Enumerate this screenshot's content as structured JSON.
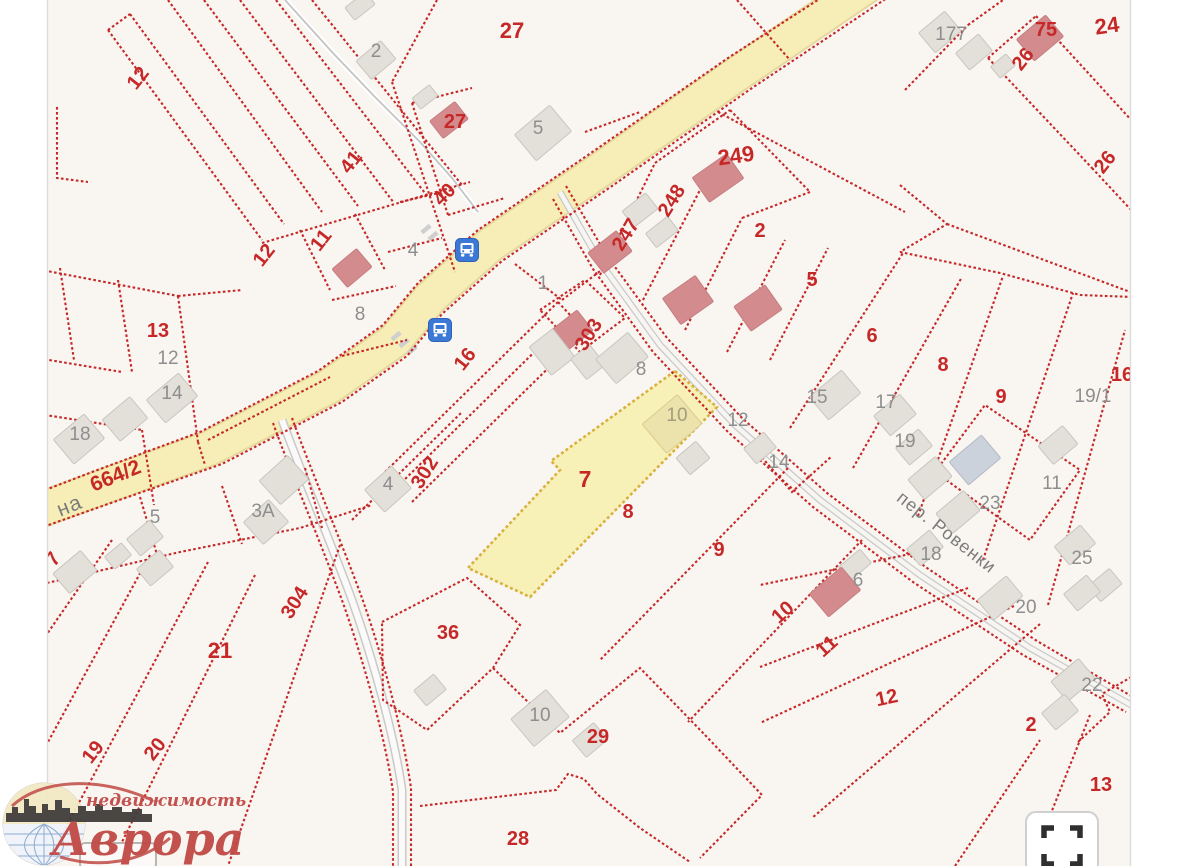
{
  "map": {
    "selected_parcel": "7",
    "labels": [
      {
        "t": "12",
        "x": 143,
        "y": 82,
        "r": -52,
        "c": "red"
      },
      {
        "t": "41",
        "x": 356,
        "y": 166,
        "r": -52,
        "c": "red"
      },
      {
        "t": "11",
        "x": 326,
        "y": 244,
        "r": -52,
        "c": "red"
      },
      {
        "t": "12",
        "x": 269,
        "y": 259,
        "r": -52,
        "c": "red"
      },
      {
        "t": "27",
        "x": 512,
        "y": 38,
        "s": 22,
        "c": "red"
      },
      {
        "t": "27",
        "x": 455,
        "y": 128,
        "c": "red"
      },
      {
        "t": "40",
        "x": 449,
        "y": 199,
        "r": -45,
        "c": "red"
      },
      {
        "t": "249",
        "x": 737,
        "y": 163,
        "r": -8,
        "s": 22,
        "c": "red"
      },
      {
        "t": "248",
        "x": 677,
        "y": 204,
        "r": -58,
        "c": "red"
      },
      {
        "t": "247",
        "x": 631,
        "y": 238,
        "r": -58,
        "c": "red"
      },
      {
        "t": "2",
        "x": 760,
        "y": 237,
        "c": "red"
      },
      {
        "t": "5",
        "x": 812,
        "y": 286,
        "c": "red"
      },
      {
        "t": "6",
        "x": 872,
        "y": 342,
        "c": "red"
      },
      {
        "t": "8",
        "x": 943,
        "y": 371,
        "c": "red"
      },
      {
        "t": "9",
        "x": 1001,
        "y": 403,
        "c": "red"
      },
      {
        "t": "24",
        "x": 1108,
        "y": 33,
        "r": -8,
        "s": 22,
        "c": "red"
      },
      {
        "t": "75",
        "x": 1046,
        "y": 36,
        "c": "red"
      },
      {
        "t": "26",
        "x": 1028,
        "y": 63,
        "r": -52,
        "c": "red"
      },
      {
        "t": "26",
        "x": 1110,
        "y": 166,
        "r": -52,
        "c": "red"
      },
      {
        "t": "13",
        "x": 158,
        "y": 337,
        "c": "red"
      },
      {
        "t": "664/2",
        "x": 118,
        "y": 482,
        "r": -22,
        "s": 21,
        "c": "red"
      },
      {
        "t": "303",
        "x": 594,
        "y": 338,
        "r": -58,
        "c": "red"
      },
      {
        "t": "16",
        "x": 470,
        "y": 363,
        "r": -52,
        "c": "red"
      },
      {
        "t": "302",
        "x": 430,
        "y": 476,
        "r": -58,
        "c": "red"
      },
      {
        "t": "7",
        "x": 585,
        "y": 487,
        "s": 23,
        "c": "red"
      },
      {
        "t": "8",
        "x": 628,
        "y": 518,
        "c": "red"
      },
      {
        "t": "9",
        "x": 719,
        "y": 556,
        "c": "red"
      },
      {
        "t": "7",
        "x": 58,
        "y": 563,
        "r": -52,
        "c": "red"
      },
      {
        "t": "304",
        "x": 300,
        "y": 606,
        "r": -58,
        "c": "red"
      },
      {
        "t": "21",
        "x": 220,
        "y": 658,
        "s": 22,
        "c": "red"
      },
      {
        "t": "19",
        "x": 98,
        "y": 756,
        "r": -52,
        "c": "red"
      },
      {
        "t": "20",
        "x": 160,
        "y": 753,
        "r": -52,
        "c": "red"
      },
      {
        "t": "36",
        "x": 448,
        "y": 639,
        "c": "red"
      },
      {
        "t": "29",
        "x": 598,
        "y": 743,
        "c": "red"
      },
      {
        "t": "28",
        "x": 518,
        "y": 845,
        "c": "red"
      },
      {
        "t": "10",
        "x": 787,
        "y": 617,
        "r": -42,
        "c": "red"
      },
      {
        "t": "11",
        "x": 831,
        "y": 651,
        "r": -42,
        "c": "red"
      },
      {
        "t": "12",
        "x": 888,
        "y": 704,
        "r": -12,
        "c": "red"
      },
      {
        "t": "2",
        "x": 1031,
        "y": 731,
        "c": "red"
      },
      {
        "t": "13",
        "x": 1101,
        "y": 791,
        "c": "red"
      },
      {
        "t": "16",
        "x": 1122,
        "y": 381,
        "c": "red"
      },
      {
        "t": "2",
        "x": 376,
        "y": 57,
        "c": "gray"
      },
      {
        "t": "5",
        "x": 538,
        "y": 134,
        "c": "gray"
      },
      {
        "t": "4",
        "x": 413,
        "y": 256,
        "c": "gray"
      },
      {
        "t": "1",
        "x": 543,
        "y": 289,
        "c": "gray"
      },
      {
        "t": "177",
        "x": 951,
        "y": 40,
        "c": "gray"
      },
      {
        "t": "12",
        "x": 168,
        "y": 364,
        "c": "gray"
      },
      {
        "t": "14",
        "x": 172,
        "y": 399,
        "c": "gray"
      },
      {
        "t": "18",
        "x": 80,
        "y": 440,
        "c": "gray"
      },
      {
        "t": "5",
        "x": 155,
        "y": 523,
        "c": "gray"
      },
      {
        "t": "3А",
        "x": 263,
        "y": 517,
        "c": "gray"
      },
      {
        "t": "8",
        "x": 360,
        "y": 320,
        "c": "gray"
      },
      {
        "t": "4",
        "x": 388,
        "y": 490,
        "c": "gray"
      },
      {
        "t": "8",
        "x": 641,
        "y": 375,
        "c": "gray"
      },
      {
        "t": "10",
        "x": 677,
        "y": 421,
        "c": "khaki"
      },
      {
        "t": "12",
        "x": 738,
        "y": 426,
        "c": "gray"
      },
      {
        "t": "14",
        "x": 779,
        "y": 468,
        "c": "gray"
      },
      {
        "t": "15",
        "x": 817,
        "y": 403,
        "c": "gray"
      },
      {
        "t": "17",
        "x": 886,
        "y": 408,
        "c": "gray"
      },
      {
        "t": "19",
        "x": 905,
        "y": 447,
        "c": "gray"
      },
      {
        "t": "19/1",
        "x": 1093,
        "y": 402,
        "c": "gray"
      },
      {
        "t": "23",
        "x": 990,
        "y": 509,
        "c": "gray"
      },
      {
        "t": "11",
        "x": 1052,
        "y": 489,
        "c": "gray"
      },
      {
        "t": "18",
        "x": 931,
        "y": 560,
        "c": "gray"
      },
      {
        "t": "25",
        "x": 1082,
        "y": 564,
        "c": "gray"
      },
      {
        "t": "6",
        "x": 858,
        "y": 586,
        "c": "gray"
      },
      {
        "t": "20",
        "x": 1026,
        "y": 613,
        "c": "gray"
      },
      {
        "t": "22",
        "x": 1092,
        "y": 691,
        "c": "gray"
      },
      {
        "t": "10",
        "x": 540,
        "y": 721,
        "c": "gray"
      }
    ],
    "street_labels": [
      {
        "t": "на",
        "x": 72,
        "y": 512,
        "r": -22,
        "s": 21
      },
      {
        "t": "пер. Ровенки",
        "x": 943,
        "y": 537,
        "r": 38,
        "s": 18
      }
    ],
    "buildings": [
      {
        "x": 360,
        "y": 6,
        "w": 26,
        "h": 16,
        "r": -38,
        "c": "gray"
      },
      {
        "x": 376,
        "y": 60,
        "w": 32,
        "h": 24,
        "r": -40,
        "c": "gray"
      },
      {
        "x": 425,
        "y": 97,
        "w": 22,
        "h": 14,
        "r": -38,
        "c": "gray"
      },
      {
        "x": 449,
        "y": 120,
        "w": 32,
        "h": 22,
        "r": -38,
        "c": "red"
      },
      {
        "x": 543,
        "y": 133,
        "w": 46,
        "h": 34,
        "r": -40,
        "c": "gray"
      },
      {
        "x": 940,
        "y": 32,
        "w": 34,
        "h": 26,
        "r": -40,
        "c": "gray"
      },
      {
        "x": 974,
        "y": 52,
        "w": 30,
        "h": 22,
        "r": -40,
        "c": "gray"
      },
      {
        "x": 1003,
        "y": 66,
        "w": 20,
        "h": 15,
        "r": -40,
        "c": "gray"
      },
      {
        "x": 1040,
        "y": 38,
        "w": 38,
        "h": 28,
        "r": -40,
        "c": "red"
      },
      {
        "x": 718,
        "y": 178,
        "w": 42,
        "h": 30,
        "r": -35,
        "c": "red"
      },
      {
        "x": 640,
        "y": 210,
        "w": 30,
        "h": 20,
        "r": -38,
        "c": "gray"
      },
      {
        "x": 662,
        "y": 232,
        "w": 28,
        "h": 18,
        "r": -38,
        "c": "gray"
      },
      {
        "x": 610,
        "y": 252,
        "w": 36,
        "h": 26,
        "r": -38,
        "c": "red"
      },
      {
        "x": 688,
        "y": 300,
        "w": 40,
        "h": 32,
        "r": -35,
        "c": "red"
      },
      {
        "x": 758,
        "y": 308,
        "w": 38,
        "h": 30,
        "r": -35,
        "c": "red"
      },
      {
        "x": 352,
        "y": 268,
        "w": 32,
        "h": 24,
        "r": -40,
        "c": "red"
      },
      {
        "x": 172,
        "y": 398,
        "w": 42,
        "h": 30,
        "r": -40,
        "c": "gray"
      },
      {
        "x": 125,
        "y": 419,
        "w": 36,
        "h": 28,
        "r": -40,
        "c": "gray"
      },
      {
        "x": 79,
        "y": 439,
        "w": 40,
        "h": 32,
        "r": -40,
        "c": "gray"
      },
      {
        "x": 145,
        "y": 538,
        "w": 30,
        "h": 22,
        "r": -40,
        "c": "gray"
      },
      {
        "x": 118,
        "y": 556,
        "w": 22,
        "h": 16,
        "r": -40,
        "c": "gray"
      },
      {
        "x": 284,
        "y": 480,
        "w": 38,
        "h": 32,
        "r": -42,
        "c": "gray"
      },
      {
        "x": 266,
        "y": 522,
        "w": 34,
        "h": 30,
        "r": -42,
        "c": "gray"
      },
      {
        "x": 388,
        "y": 489,
        "w": 36,
        "h": 30,
        "r": -42,
        "c": "gray"
      },
      {
        "x": 570,
        "y": 332,
        "w": 38,
        "h": 26,
        "r": -38,
        "c": "red"
      },
      {
        "x": 552,
        "y": 352,
        "w": 30,
        "h": 36,
        "r": -38,
        "c": "gray"
      },
      {
        "x": 588,
        "y": 362,
        "w": 24,
        "h": 26,
        "r": -38,
        "c": "gray"
      },
      {
        "x": 622,
        "y": 358,
        "w": 42,
        "h": 32,
        "r": -40,
        "c": "gray"
      },
      {
        "x": 672,
        "y": 424,
        "w": 46,
        "h": 38,
        "r": -40,
        "c": "khaki"
      },
      {
        "x": 693,
        "y": 458,
        "w": 26,
        "h": 22,
        "r": -40,
        "c": "gray"
      },
      {
        "x": 835,
        "y": 395,
        "w": 42,
        "h": 30,
        "r": -40,
        "c": "gray"
      },
      {
        "x": 895,
        "y": 415,
        "w": 34,
        "h": 26,
        "r": -40,
        "c": "gray"
      },
      {
        "x": 914,
        "y": 447,
        "w": 30,
        "h": 22,
        "r": -40,
        "c": "gray"
      },
      {
        "x": 930,
        "y": 478,
        "w": 36,
        "h": 26,
        "r": -40,
        "c": "gray"
      },
      {
        "x": 975,
        "y": 460,
        "w": 42,
        "h": 30,
        "r": -40,
        "c": "blue"
      },
      {
        "x": 958,
        "y": 512,
        "w": 36,
        "h": 26,
        "r": -40,
        "c": "gray"
      },
      {
        "x": 1058,
        "y": 445,
        "w": 32,
        "h": 24,
        "r": -40,
        "c": "gray"
      },
      {
        "x": 760,
        "y": 448,
        "w": 26,
        "h": 20,
        "r": -40,
        "c": "gray"
      },
      {
        "x": 925,
        "y": 548,
        "w": 30,
        "h": 22,
        "r": -40,
        "c": "gray"
      },
      {
        "x": 1075,
        "y": 545,
        "w": 34,
        "h": 24,
        "r": -40,
        "c": "gray"
      },
      {
        "x": 1105,
        "y": 585,
        "w": 28,
        "h": 20,
        "r": -40,
        "c": "gray"
      },
      {
        "x": 855,
        "y": 565,
        "w": 28,
        "h": 18,
        "r": -40,
        "c": "gray"
      },
      {
        "x": 835,
        "y": 592,
        "w": 42,
        "h": 30,
        "r": -40,
        "c": "red"
      },
      {
        "x": 1000,
        "y": 598,
        "w": 38,
        "h": 26,
        "r": -40,
        "c": "gray"
      },
      {
        "x": 1082,
        "y": 593,
        "w": 30,
        "h": 22,
        "r": -40,
        "c": "gray"
      },
      {
        "x": 1073,
        "y": 680,
        "w": 36,
        "h": 26,
        "r": -40,
        "c": "gray"
      },
      {
        "x": 1060,
        "y": 712,
        "w": 30,
        "h": 22,
        "r": -40,
        "c": "gray"
      },
      {
        "x": 540,
        "y": 718,
        "w": 46,
        "h": 36,
        "r": -40,
        "c": "gray"
      },
      {
        "x": 590,
        "y": 740,
        "w": 28,
        "h": 22,
        "r": -40,
        "c": "gray"
      },
      {
        "x": 430,
        "y": 690,
        "w": 26,
        "h": 20,
        "r": -40,
        "c": "gray"
      },
      {
        "x": 75,
        "y": 572,
        "w": 36,
        "h": 26,
        "r": -40,
        "c": "gray"
      },
      {
        "x": 155,
        "y": 568,
        "w": 30,
        "h": 22,
        "r": -40,
        "c": "gray"
      },
      {
        "x": 118,
        "y": 856,
        "w": 76,
        "h": 26,
        "r": 0,
        "c": "outline"
      }
    ],
    "bus_stops": [
      {
        "x": 467,
        "y": 250
      },
      {
        "x": 440,
        "y": 330
      }
    ],
    "crosswalk": [
      {
        "x": 396,
        "y": 336
      },
      {
        "x": 404,
        "y": 343
      },
      {
        "x": 412,
        "y": 350
      },
      {
        "x": 426,
        "y": 229
      },
      {
        "x": 433,
        "y": 236
      }
    ]
  },
  "watermark": {
    "brand": "Аврора",
    "tagline": "недвижимость"
  },
  "controls": {
    "fullscreen": "fullscreen-icon"
  },
  "colors": {
    "boundary_red": "#c41f1f",
    "label_red": "#c62828",
    "label_gray": "#8e8e8e",
    "road_yellow": "#f6eeb6",
    "highlight_fill": "#f7efad",
    "highlight_stroke": "#d9b23e",
    "building_gray": "#e3e0da",
    "building_red": "#d38b8d",
    "bus_blue": "#3c79d6",
    "background": "#f9f6f2",
    "logo_red": "#c14a46"
  }
}
